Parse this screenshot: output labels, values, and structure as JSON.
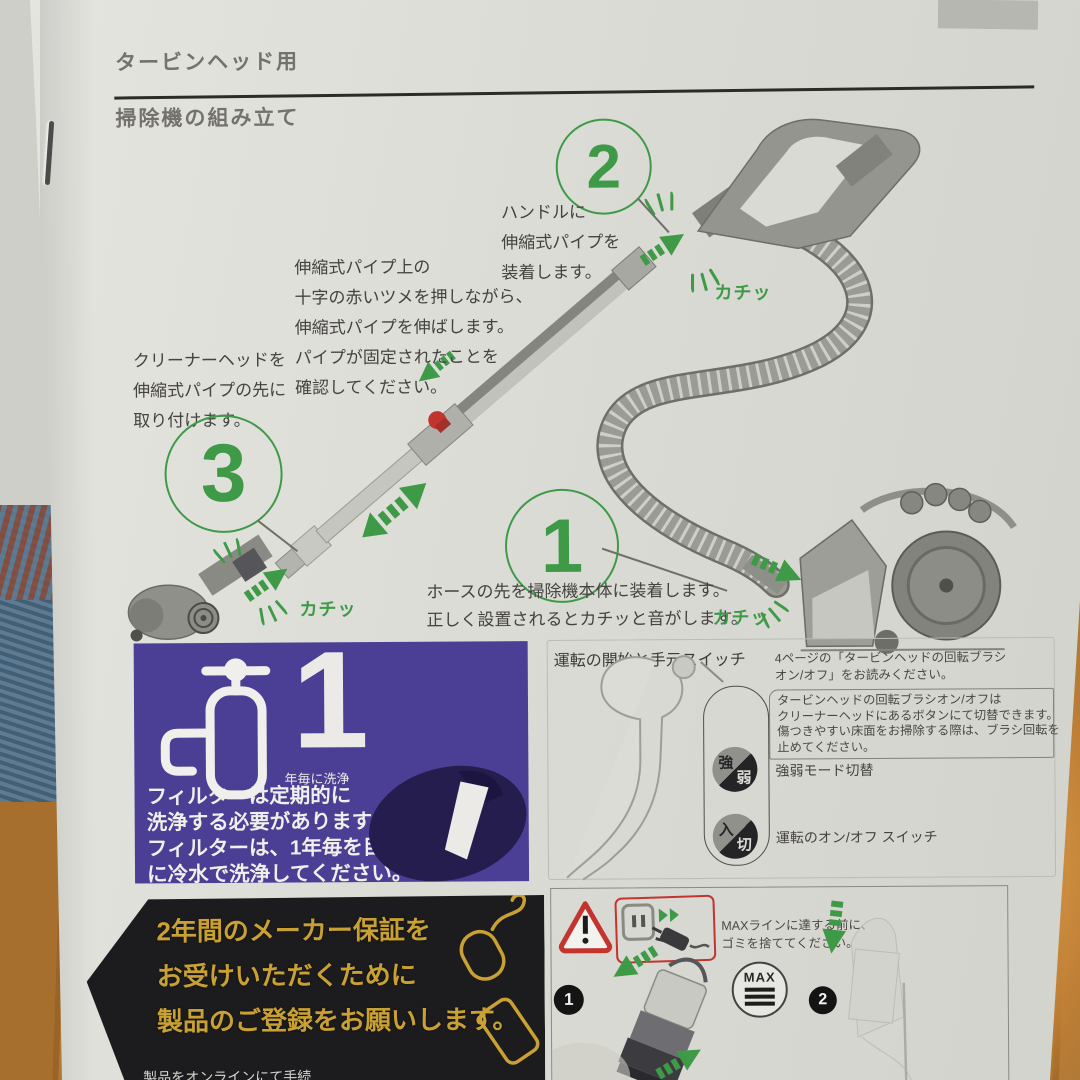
{
  "colors": {
    "green": "#3f9a47",
    "purple": "#4b3e95",
    "gold": "#c9a133",
    "red": "#c4342e",
    "ink": "#403e3b",
    "titleink": "#74726d"
  },
  "page": {
    "title": "タービンヘッド用",
    "subtitle": "掃除機の組み立て"
  },
  "assembly": {
    "step2": {
      "number": "2",
      "text": "ハンドルに\n伸縮式パイプを\n装着します。",
      "sfx": "カチッ"
    },
    "pipe_tip": "伸縮式パイプ上の\n十字の赤いツメを押しながら、\n伸縮式パイプを伸ばします。\nパイプが固定されたことを\n確認してください。",
    "step3": {
      "number": "3",
      "text": "クリーナーヘッドを\n伸縮式パイプの先に\n取り付けます。",
      "sfx": "カチッ"
    },
    "step1": {
      "number": "1",
      "text": "ホースの先を掃除機本体に装着します。\n正しく設置されるとカチッと音がします。",
      "sfx": "カチッ"
    }
  },
  "filter_box": {
    "big_number": "1",
    "caption": "年毎に洗浄",
    "text": "フィルターは定期的に\n洗浄する必要があります。\nフィルターは、1年毎を目安\nに冷水で洗浄してください。"
  },
  "warranty_box": {
    "text": "2年間のメーカー保証を\nお受けいただくために\n製品のご登録をお願いします。",
    "partial_footer": "製品をオンラインにて手続"
  },
  "operation": {
    "heading": "運転の開始と手元スイッチ",
    "reference": "4ページの「タービンヘッドの回転ブラシ\nオン/オフ」をお読みください。",
    "note": "タービンヘッドの回転ブラシオン/オフは\nクリーナーヘッドにあるボタンにて切替できます。\n傷つきやすい床面をお掃除する際は、ブラシ回転を\n止めてください。",
    "power_switch": {
      "top": "強",
      "bottom": "弱",
      "label": "強弱モード切替"
    },
    "onoff_switch": {
      "top": "入",
      "bottom": "切",
      "label": "運転のオン/オフ スイッチ"
    }
  },
  "bin": {
    "warning": "MAXラインに達する前に、\nゴミを捨ててください。",
    "max_label": "MAX",
    "step1_number": "1",
    "step2_number": "2"
  }
}
